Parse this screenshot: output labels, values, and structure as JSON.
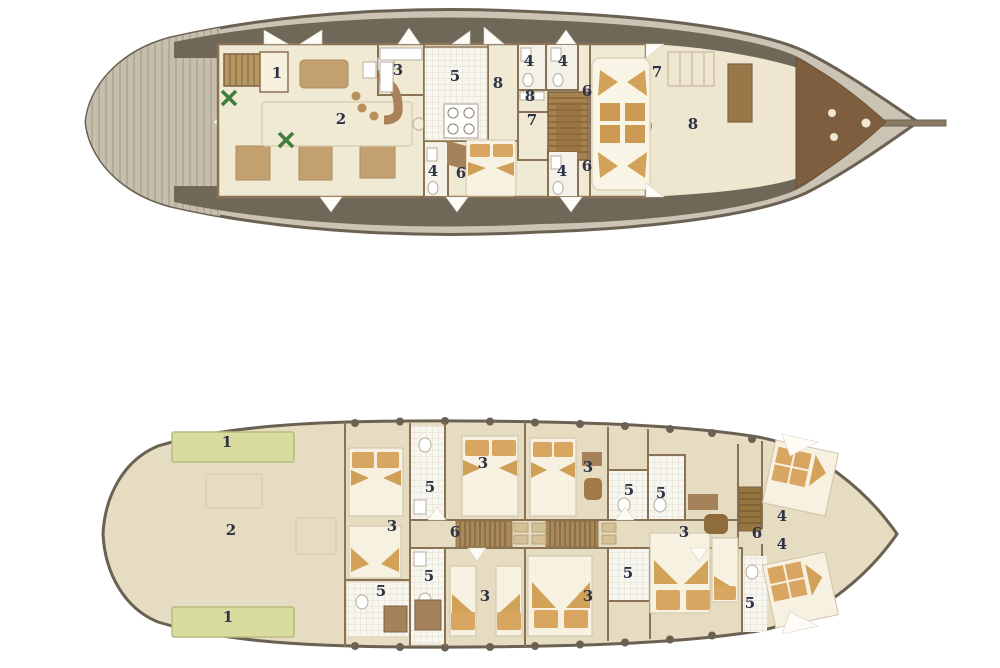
{
  "palette": {
    "hull_outline": "#6b6153",
    "hull_fill": "#cbc3b3",
    "side_deck": "#6f6859",
    "cabin_floor": "#f0e9d4",
    "aft_open_deck": "#eee6cf",
    "lower_deck_floor": "#e6dcc2",
    "wall": "#8a7355",
    "furniture_tan": "#c3a070",
    "bed_linen": "#f6f1e1",
    "pillow_tan": "#d8a660",
    "stair_wood": "#a5824f",
    "aft_deck_wood": "#7d5f3f",
    "tank_green": "#d8dc9e",
    "plant_green": "#3e7e3b",
    "label_color": "#2e3247"
  },
  "decks": [
    {
      "id": "upper-deck",
      "name": "Upper deck plan",
      "labels": [
        {
          "n": "1",
          "x": 277,
          "y": 74
        },
        {
          "n": "2",
          "x": 341,
          "y": 120
        },
        {
          "n": "3",
          "x": 398,
          "y": 71
        },
        {
          "n": "5",
          "x": 455,
          "y": 77
        },
        {
          "n": "8",
          "x": 498,
          "y": 84
        },
        {
          "n": "4",
          "x": 529,
          "y": 62
        },
        {
          "n": "4",
          "x": 563,
          "y": 62
        },
        {
          "n": "8",
          "x": 530,
          "y": 97
        },
        {
          "n": "6",
          "x": 587,
          "y": 92
        },
        {
          "n": "7",
          "x": 532,
          "y": 121
        },
        {
          "n": "7",
          "x": 657,
          "y": 73
        },
        {
          "n": "8",
          "x": 693,
          "y": 125
        },
        {
          "n": "4",
          "x": 433,
          "y": 172
        },
        {
          "n": "6",
          "x": 461,
          "y": 174
        },
        {
          "n": "4",
          "x": 562,
          "y": 172
        },
        {
          "n": "6",
          "x": 587,
          "y": 167
        }
      ]
    },
    {
      "id": "lower-deck",
      "name": "Lower deck plan",
      "labels": [
        {
          "n": "1",
          "x": 227,
          "y": 443
        },
        {
          "n": "2",
          "x": 231,
          "y": 531
        },
        {
          "n": "1",
          "x": 228,
          "y": 618
        },
        {
          "n": "3",
          "x": 483,
          "y": 464
        },
        {
          "n": "5",
          "x": 430,
          "y": 488
        },
        {
          "n": "3",
          "x": 588,
          "y": 468
        },
        {
          "n": "5",
          "x": 629,
          "y": 491
        },
        {
          "n": "5",
          "x": 661,
          "y": 494
        },
        {
          "n": "3",
          "x": 684,
          "y": 533
        },
        {
          "n": "6",
          "x": 455,
          "y": 533
        },
        {
          "n": "6",
          "x": 757,
          "y": 534
        },
        {
          "n": "4",
          "x": 782,
          "y": 517
        },
        {
          "n": "4",
          "x": 782,
          "y": 545
        },
        {
          "n": "3",
          "x": 392,
          "y": 527
        },
        {
          "n": "5",
          "x": 381,
          "y": 592
        },
        {
          "n": "5",
          "x": 429,
          "y": 577
        },
        {
          "n": "3",
          "x": 485,
          "y": 597
        },
        {
          "n": "5",
          "x": 628,
          "y": 574
        },
        {
          "n": "3",
          "x": 588,
          "y": 597
        },
        {
          "n": "5",
          "x": 750,
          "y": 604
        }
      ]
    }
  ]
}
